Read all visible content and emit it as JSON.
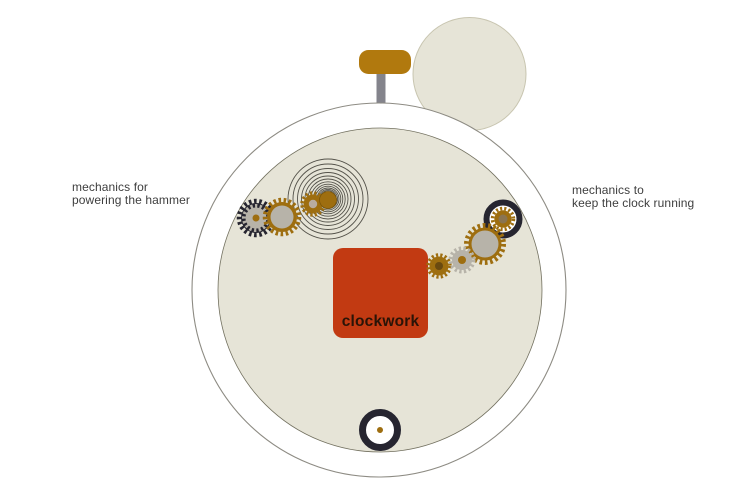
{
  "annotations": {
    "left": {
      "line1": "mechanics for",
      "line2": "powering the hammer"
    },
    "right": {
      "line1": "mechanics to",
      "line2": "keep the clock running"
    }
  },
  "clockwork_block": {
    "label": "clockwork"
  },
  "parts": [
    "winding-crown",
    "crown-stem",
    "alarm-bell",
    "clock-case",
    "clock-face",
    "mainspring-spiral",
    "hammer-gear-train",
    "clock-gear-train",
    "clockwork-block",
    "balance-wheel"
  ],
  "colors": {
    "background": "#ffffff",
    "case_fill": "#ffffff",
    "case_stroke": "#8d8b83",
    "face_fill": "#e6e4d7",
    "face_stroke": "#72705f",
    "bell_fill": "#e6e4d7",
    "bell_stroke": "#c8c5b0",
    "crown_gold": "#b1790e",
    "stem_gray": "#84848c",
    "gold": "#9e6e10",
    "gold_rim": "#7c5608",
    "gray_gear": "#b7b3a9",
    "dark": "#262530",
    "spiral": "#55534b",
    "red_block": "#c23a12",
    "red_label": "#2a1407",
    "annotation_text": "#3e3e3e",
    "wheel_center_light": "#e7e1cb",
    "wheel_center_brown": "#8a7450",
    "small_center_dark": "#6a4a10",
    "small_center_gray": "#b9ac9f"
  }
}
